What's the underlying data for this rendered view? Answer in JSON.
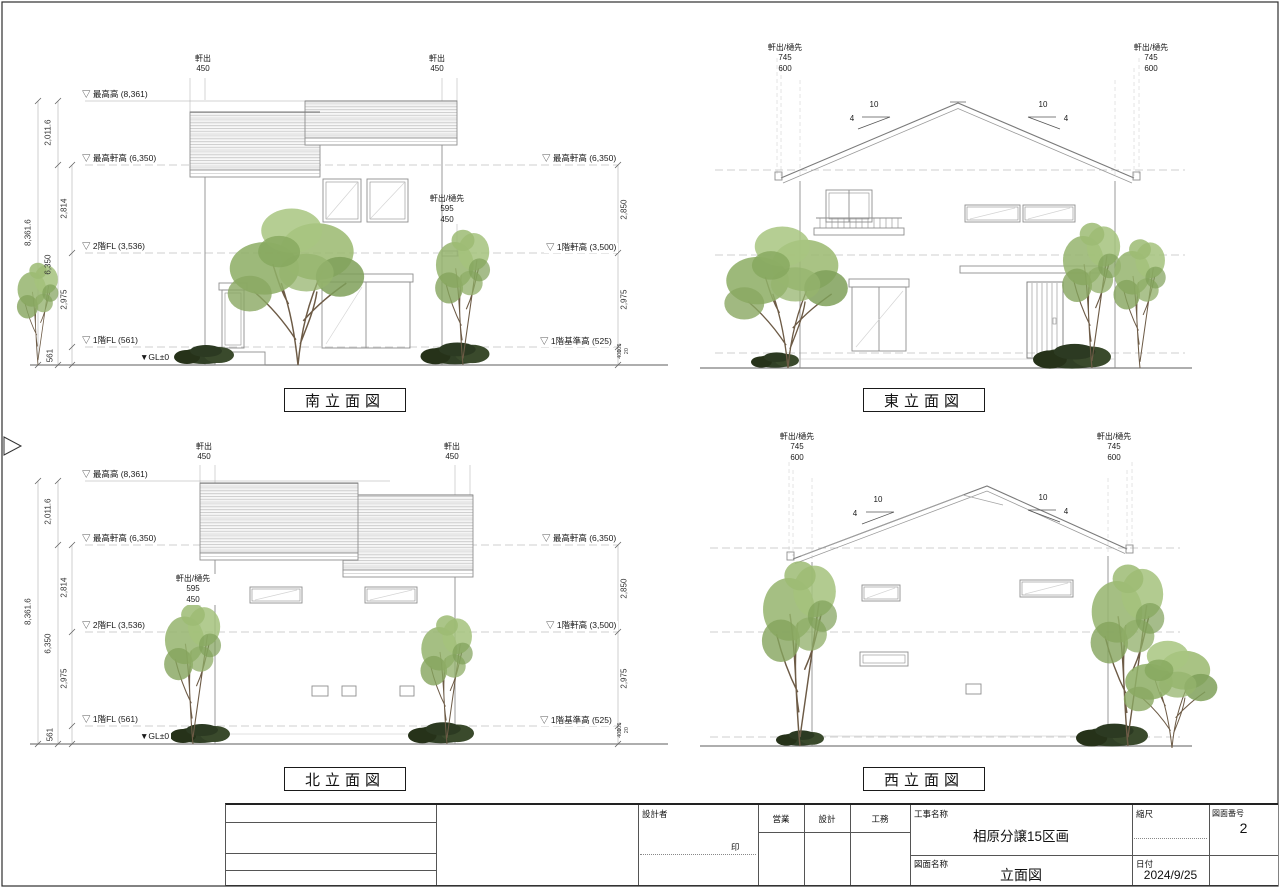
{
  "views": {
    "south": {
      "title": "南立面図",
      "eave_left": [
        "軒出",
        "450"
      ],
      "eave_right": [
        "軒出",
        "450"
      ],
      "eave_mid": [
        "軒出/樋先",
        "595",
        "450"
      ],
      "levels_left": [
        "▽ 最高高 (8,361)",
        "▽ 最高軒高 (6,350)",
        "▽ 2階FL (3,536)",
        "▽ 1階FL (561)"
      ],
      "gl": "▼GL±0",
      "dims_left": [
        "8,361.6",
        "2,011.6",
        "6,350",
        "2,814",
        "2,975",
        "561"
      ],
      "levels_right": [
        "▽ 最高軒高 (6,350)",
        "▽ 1階軒高 (3,500)",
        "▽ 1階基準高 (525)"
      ],
      "dims_right": [
        "2,850",
        "2,975",
        "400",
        "105",
        "20"
      ]
    },
    "north": {
      "title": "北立面図",
      "eave_left": [
        "軒出",
        "450"
      ],
      "eave_right": [
        "軒出",
        "450"
      ],
      "eave_mid": [
        "軒出/樋先",
        "595",
        "450"
      ],
      "levels_left": [
        "▽ 最高高 (8,361)",
        "▽ 最高軒高 (6,350)",
        "▽ 2階FL (3,536)",
        "▽ 1階FL (561)"
      ],
      "gl": "▼GL±0",
      "dims_left": [
        "8,361.6",
        "2,011.6",
        "6,350",
        "2,814",
        "2,975",
        "561"
      ],
      "levels_right": [
        "▽ 最高軒高 (6,350)",
        "▽ 1階軒高 (3,500)",
        "▽ 1階基準高 (525)"
      ],
      "dims_right": [
        "2,850",
        "2,975",
        "400",
        "105",
        "20"
      ]
    },
    "east": {
      "title": "東立面図",
      "eave_left": [
        "軒出/樋先",
        "745",
        "600"
      ],
      "eave_right": [
        "軒出/樋先",
        "745",
        "600"
      ],
      "slope_left": {
        "run": "10",
        "rise": "4"
      },
      "slope_right": {
        "run": "10",
        "rise": "4"
      }
    },
    "west": {
      "title": "西立面図",
      "eave_left": [
        "軒出/樋先",
        "745",
        "600"
      ],
      "eave_right": [
        "軒出/樋先",
        "745",
        "600"
      ],
      "slope_left": {
        "run": "10",
        "rise": "4"
      },
      "slope_right": {
        "run": "10",
        "rise": "4"
      }
    }
  },
  "titleblock": {
    "designer_label": "設計者",
    "seal": "印",
    "col_sales": "営業",
    "col_design": "設計",
    "col_works": "工務",
    "project_label": "工事名称",
    "project_name": "相原分譲15区画",
    "drawing_label": "図面名称",
    "drawing_name": "立面図",
    "scale_label": "縮尺",
    "date_label": "日付",
    "date": "2024/9/25",
    "number_label": "図面番号",
    "number": "2"
  }
}
